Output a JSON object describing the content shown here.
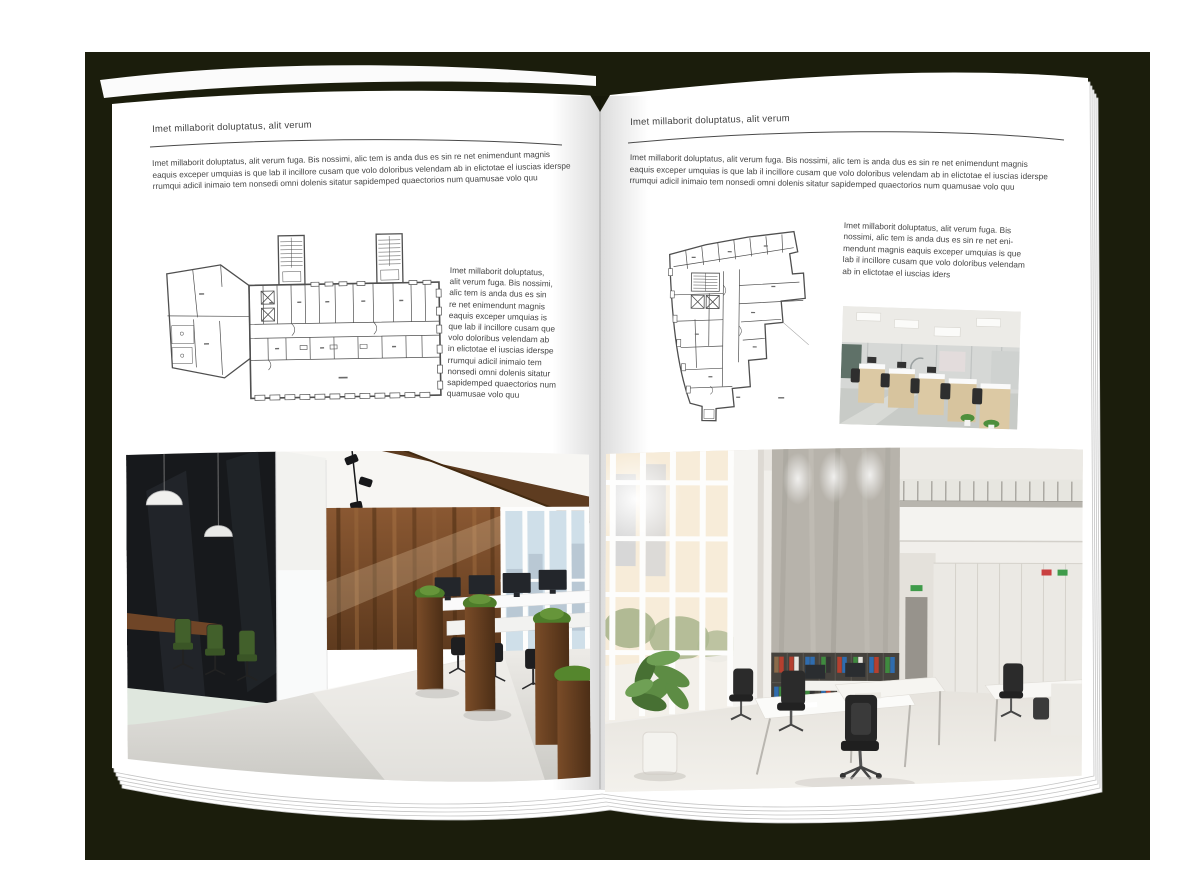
{
  "colors": {
    "backdrop": "#1b1d0c",
    "page": "#ffffff",
    "body_text": "#454545",
    "header_rule": "#4a4a4a",
    "plan_line": "#4f4f4f",
    "wood_panel": "#7a4e2c",
    "grass_green": "#4f7c2b",
    "meeting_chair_green": "#42602b",
    "binder_red": "#b5402f",
    "binder_blue": "#2f6cae",
    "binder_green": "#3f8a3f"
  },
  "left_page": {
    "header": "Imet millaborit doluptatus, alit verum",
    "intro_lines": [
      "Imet millaborit doluptatus, alit verum fuga. Bis nossimi, alic tem is anda dus es sin re net enimendunt magnis",
      "eaquis exceper umquias is que lab il incillore cusam que volo doloribus velendam ab in elictotae el iuscias iderspe",
      "rrumqui adicil inimaio tem nonsedi omni dolenis sitatur sapidemped quaectorios num quamusae volo quu"
    ],
    "side_lines": [
      "Imet millaborit doluptatus,",
      "alit verum fuga. Bis nossimi,",
      "alic tem is anda dus es sin",
      "re net enimendunt magnis",
      "eaquis exceper umquias is",
      "que lab il incillore cusam que",
      "volo doloribus velendam ab",
      "in elictotae el iuscias iderspe",
      "rrumqui adicil inimaio tem",
      "nonsedi omni dolenis sitatur",
      "sapidemped quaectorios num",
      "quamusae volo quu"
    ]
  },
  "right_page": {
    "header": "Imet millaborit doluptatus, alit verum",
    "intro_lines": [
      "Imet millaborit doluptatus, alit verum fuga. Bis nossimi, alic tem is anda dus es sin re net enimendunt magnis",
      "eaquis exceper umquias is que lab il incillore cusam que volo doloribus velendam ab in elictotae el iuscias iderspe",
      "rrumqui adicil inimaio tem nonsedi omni dolenis sitatur sapidemped quaectorios num quamusae volo quu"
    ],
    "side_lines": [
      "Imet millaborit doluptatus, alit verum fuga. Bis",
      "nossimi, alic tem is anda dus es sin re net eni-",
      "mendunt magnis eaquis exceper umquias is que",
      "lab il incillore cusam que volo doloribus velendam",
      "ab in elictotae el iuscias iders"
    ]
  }
}
